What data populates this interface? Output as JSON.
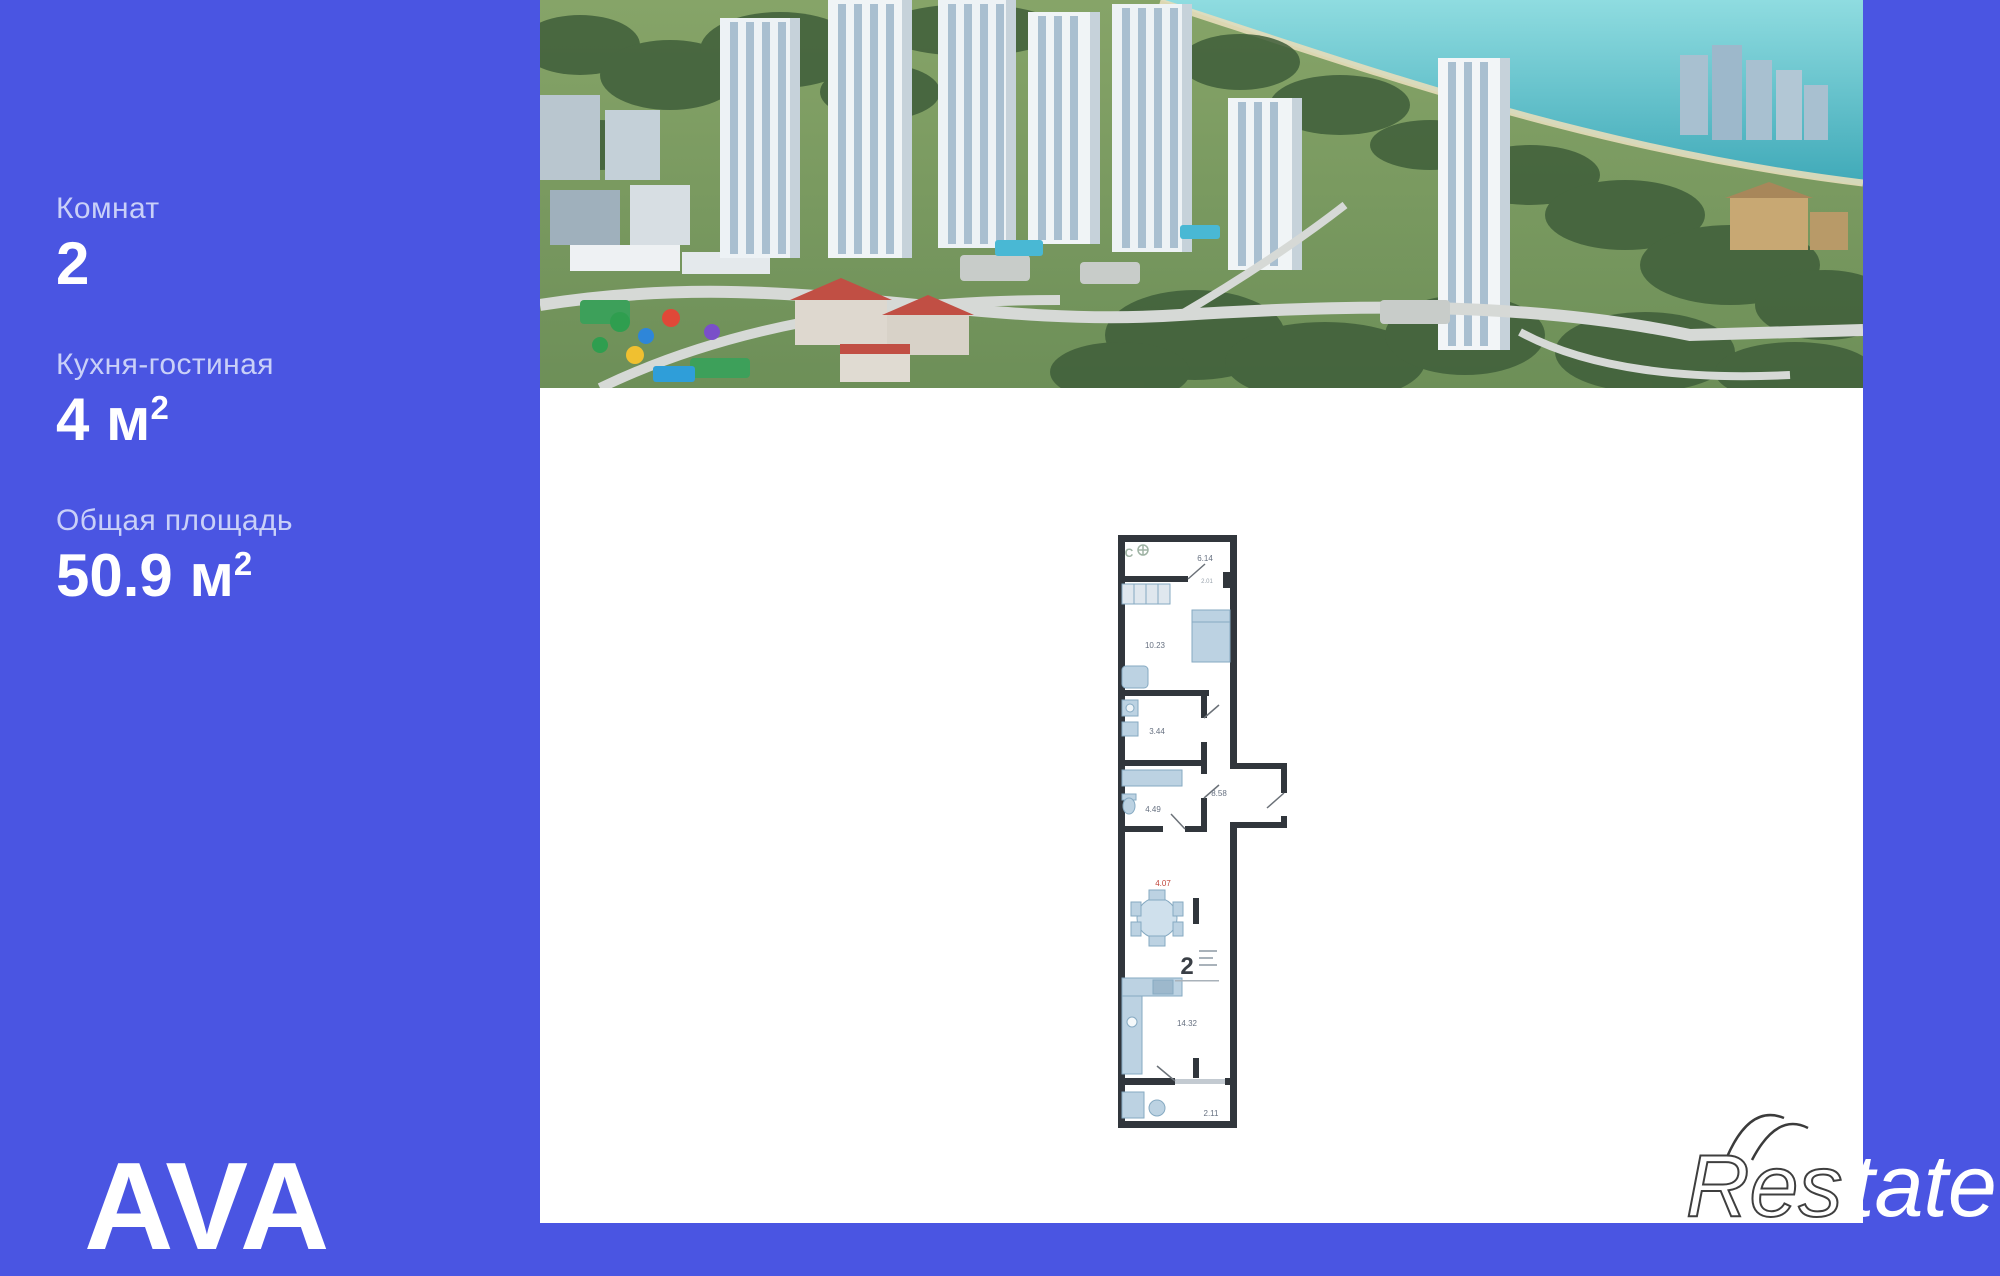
{
  "colors": {
    "background": "#4a55e2",
    "panel": "#ffffff",
    "plan_wall": "#31363c",
    "accent_red": "#c0453a",
    "sea": "#5fc6cc"
  },
  "sidebar": {
    "stats": [
      {
        "label": "Комнат",
        "value": "2",
        "unit": "",
        "sup": ""
      },
      {
        "label": "Кухня-гостиная",
        "value": "4",
        "unit": " м",
        "sup": "2"
      },
      {
        "label": "Общая площадь",
        "value": "50.9",
        "unit": " м",
        "sup": "2"
      }
    ],
    "logo": "AVA"
  },
  "plan": {
    "compass": "С",
    "stamp": "2",
    "labels": {
      "hall": "6.14",
      "hall_small": "2.01",
      "bedroom": "10.23",
      "bathroom": "3.44",
      "wc": "4.49",
      "corridor": "8.58",
      "kitchen_niche": "4.07",
      "living": "14.32",
      "balcony": "2.11"
    }
  },
  "watermark": {
    "outline": "Res",
    "solid": "tate"
  }
}
